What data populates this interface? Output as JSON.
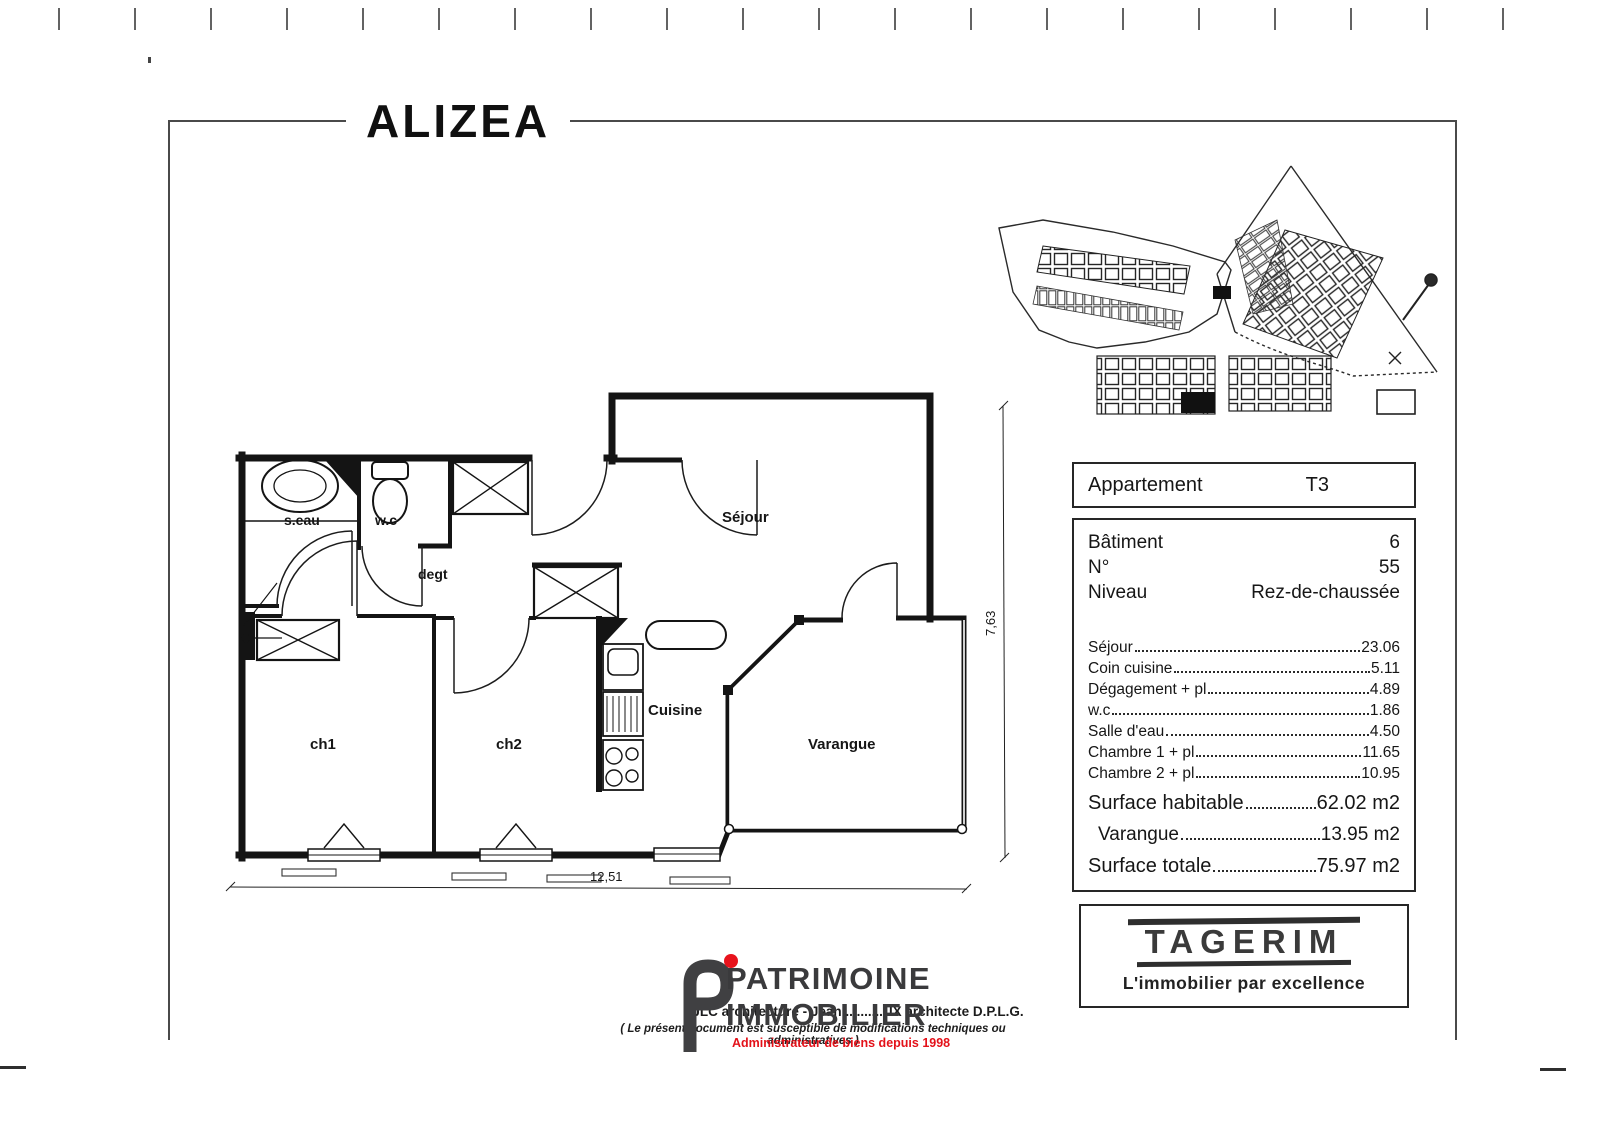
{
  "page": {
    "title": "ALIZEA"
  },
  "floor_plan": {
    "rooms": [
      {
        "id": "seau",
        "label": "s.eau"
      },
      {
        "id": "wc",
        "label": "w.c"
      },
      {
        "id": "degt",
        "label": "degt"
      },
      {
        "id": "sejour",
        "label": "Séjour"
      },
      {
        "id": "ch1",
        "label": "ch1"
      },
      {
        "id": "ch2",
        "label": "ch2"
      },
      {
        "id": "cuisine",
        "label": "Cuisine"
      },
      {
        "id": "varangue",
        "label": "Varangue"
      }
    ],
    "dimensions": {
      "width": "12,51",
      "height": "7,63"
    }
  },
  "info_card": {
    "apartment_label": "Appartement",
    "apartment_value": "T3",
    "rows": [
      {
        "label": "Bâtiment",
        "value": "6"
      },
      {
        "label": "N°",
        "value": "55"
      },
      {
        "label": "Niveau",
        "value": "Rez-de-chaussée"
      }
    ],
    "areas": [
      {
        "label": "Séjour ",
        "value": "23.06"
      },
      {
        "label": "Coin cuisine",
        "value": "5.11"
      },
      {
        "label": "Dégagement + pl",
        "value": "4.89"
      },
      {
        "label": "w.c",
        "value": "1.86"
      },
      {
        "label": "Salle d'eau",
        "value": "4.50"
      },
      {
        "label": "Chambre 1 + pl",
        "value": "11.65"
      },
      {
        "label": "Chambre 2 + pl",
        "value": "10.95"
      }
    ],
    "totals": [
      {
        "label": "Surface habitable",
        "value": "62.02 m2"
      },
      {
        "label": "Varangue",
        "value": "13.95 m2"
      },
      {
        "label": "Surface totale",
        "value": "75.97 m2"
      }
    ]
  },
  "agency": {
    "name": "TAGERIM",
    "tagline": "L'immobilier par excellence"
  },
  "branding": {
    "name_line1": "PATRIMOINE",
    "name_line2": "IMMOBILIER",
    "subtitle": "Administrateur de biens depuis 1998",
    "accent_color": "#e31119",
    "gray_color": "#3a3a3c"
  },
  "footer": {
    "architect_line": "JLC architecture - Jean ..........UX architecte D.P.L.G.",
    "disclaimer": "( Le présent document est susceptible de modifications techniques ou administratives )"
  }
}
